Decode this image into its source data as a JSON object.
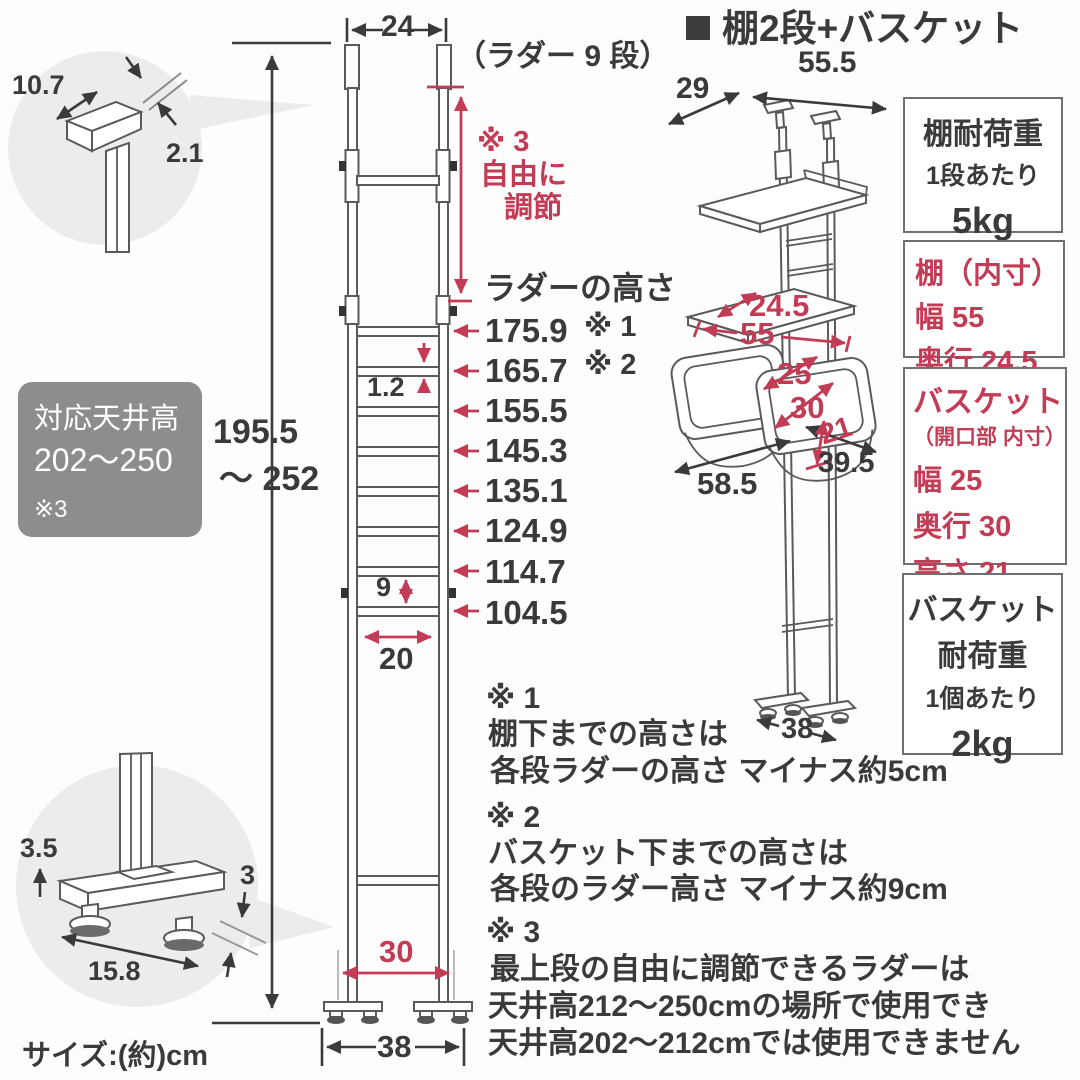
{
  "size_unit_note": "サイズ:(約)cm",
  "top_detail": {
    "cap_length": "10.7",
    "ceiling_gap": "2.1"
  },
  "bottom_detail": {
    "foot_height": "3.5",
    "floor_gap": "3",
    "base_length": "15.8"
  },
  "ceiling_badge": {
    "title": "対応天井高",
    "range": "202〜250",
    "ref": "※3"
  },
  "overall_height": {
    "value": "195.5",
    "range_to": "〜 252"
  },
  "ladder": {
    "top_width": "24",
    "steps_label": "（ラダー 9 段）",
    "adjust_ref": "※ 3",
    "adjust_note1": "自由に",
    "adjust_note2": "調節",
    "heights_title": "ラダーの高さ",
    "heights_ref1": "※ 1",
    "heights_ref2": "※ 2",
    "heights": [
      "175.9",
      "165.7",
      "155.5",
      "145.3",
      "135.1",
      "124.9",
      "114.7",
      "104.5"
    ],
    "rung_thickness": "1.2",
    "rung_gap": "9",
    "inner_width": "20",
    "feet_span": "30",
    "outer_width": "38"
  },
  "right_diagram": {
    "title": "棚2段+バスケット",
    "depth": "29",
    "width": "55.5",
    "shelf_depth": "24.5",
    "shelf_width": "55",
    "basket_width": "25",
    "basket_depth": "30",
    "basket_height": "21",
    "overall_width": "58.5",
    "overall_depth": "39.5",
    "base_width": "38"
  },
  "spec_boxes": {
    "shelf_load": {
      "title": "棚耐荷重",
      "per": "1段あたり",
      "value": "5kg"
    },
    "shelf_inner": {
      "title": "棚（内寸）",
      "line1": "幅 55",
      "line2": "奥行 24.5"
    },
    "basket_inner": {
      "title": "バスケット",
      "subtitle": "（開口部 内寸）",
      "line1": "幅 25",
      "line2": "奥行 30",
      "line3": "高さ 21"
    },
    "basket_load": {
      "title": "バスケット",
      "title2": "耐荷重",
      "per": "1個あたり",
      "value": "2kg"
    }
  },
  "notes": {
    "n1_ref": "※ 1",
    "n1_line1": "棚下までの高さは",
    "n1_line2": "各段ラダーの高さ マイナス約5cm",
    "n2_ref": "※ 2",
    "n2_line1": "バスケット下までの高さは",
    "n2_line2": "各段のラダー高さ マイナス約9cm",
    "n3_ref": "※ 3",
    "n3_line1": "最上段の自由に調節できるラダーは",
    "n3_line2": "天井高212〜250cmの場所で使用でき",
    "n3_line3": "天井高202〜212cmでは使用できません"
  },
  "colors": {
    "accent_red": "#c23c55",
    "badge_gray": "#8d8d8d",
    "ink": "#3a3a3a"
  }
}
